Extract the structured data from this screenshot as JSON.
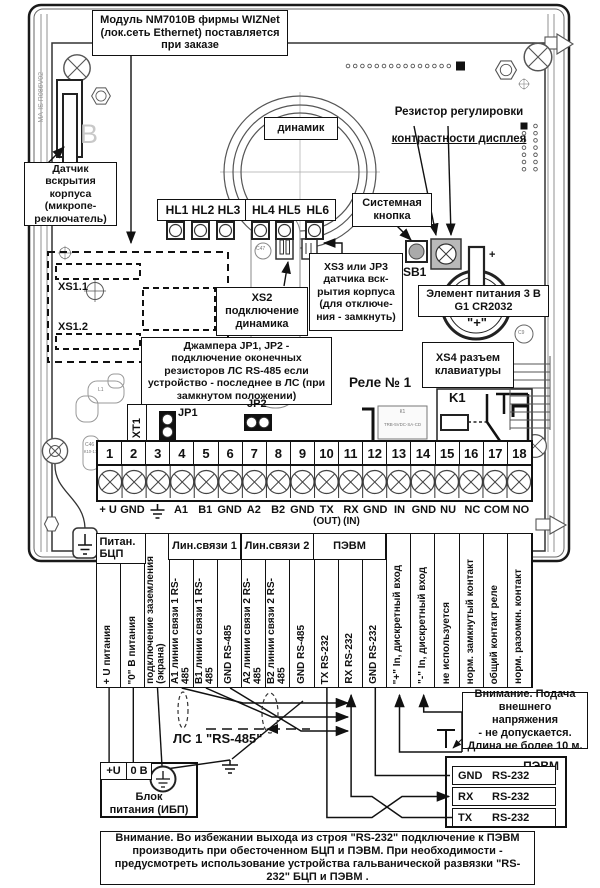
{
  "board": {
    "module_note": "Модуль NM7010В фирмы WIZNet\n(лок.сеть Ethernet) поставляется\nпри заказе",
    "tamper_note": "Датчик вскрытия\nкорпуса (микропе-\nреключатель)",
    "speaker_label": "динамик",
    "contrast_note_line1": "Резистор регулировки",
    "contrast_note_line2": "контрастности дисплея",
    "system_button_note": "Системная\nкнопка",
    "sb1_label": "SB1",
    "battery_note": "Элемент питания 3 В\nG1 CR2032",
    "battery_plus": "\"+\"",
    "battery_clip_plus": "+",
    "xs2_note": "XS2\nподключение\nдинамика",
    "xs3_note": "XS3 или JP3\nдатчика вск-\nрытия корпуса\n(для отключе-\nния - замкнуть)",
    "xs4_note": "XS4 разъем\nклавиатуры",
    "jumper_note": "Джампера JP1, JP2 -\nподключение оконечных\nрезисторов ЛС RS-485 если\nустройство - последнее в ЛС (при\nзамкнутом положении)",
    "xs11_label": "XS1.1",
    "xs12_label": "XS1.2",
    "jp1_label": "JP1",
    "jp2_label": "JP2",
    "xt1_label": "XT1",
    "relay_title": "Реле № 1",
    "k1_label": "K1",
    "relay_ref": "К1",
    "relay_part": "TRB-5VDC-SA-CD",
    "hl123_label": "HL1 HL2 HL3",
    "hl45_label": "HL4 HL5",
    "hl6_label": "HL6",
    "board_code": "MA-IS  R086V02",
    "letter_b": "B",
    "c47_ref": "C47",
    "c46_ref": "C46",
    "c46_type": "К10-17",
    "c9_ref": "C9",
    "l1_ref": "L1"
  },
  "terminals": {
    "numbers": [
      "1",
      "2",
      "3",
      "4",
      "5",
      "6",
      "7",
      "8",
      "9",
      "10",
      "11",
      "12",
      "13",
      "14",
      "15",
      "16",
      "17",
      "18"
    ],
    "signals": [
      "+ U",
      "GND",
      "⏚",
      "A1",
      "B1",
      "GND",
      "A2",
      "B2",
      "GND",
      "TX",
      "RX",
      "GND",
      "IN",
      "GND",
      "NU",
      "NC",
      "COM",
      "NO"
    ],
    "tx_dir": "(OUT)",
    "rx_dir": "(IN)"
  },
  "table": {
    "header_power": "Питан.\nБЦП",
    "header_line1": "Лин.связи 1",
    "header_line2": "Лин.связи 2",
    "header_pc": "ПЭВМ",
    "columns": [
      "+ U питания",
      "\"0\" В питания",
      "подключение заземления\n(экрана)",
      "А1 линии связи 1 RS-\n485",
      "В1 линии связи 1 RS-\n485",
      "GND RS-485",
      "А2 линии связи 2 RS-\n485",
      "В2 линии связи 2 RS-\n485",
      "GND RS-485",
      "TX RS-232",
      "RX RS-232",
      "GND RS-232",
      "\"+\" In, дискретный вход",
      "\"-\" In, дискретный вход",
      "не используется",
      "норм. замкнутый контакт",
      "общий контакт реле",
      "норм. разомкн. контакт"
    ]
  },
  "wiring": {
    "ls1_label": "ЛС 1 \"RS-485\"",
    "psu": {
      "plus": "+U",
      "zero": "0 В",
      "label": "Блок\nпитания (ИБП)"
    },
    "pc": {
      "title": "ПЭВМ",
      "rows": [
        {
          "sig": "GND",
          "bus": "RS-232"
        },
        {
          "sig": "RX",
          "bus": "RS-232"
        },
        {
          "sig": "TX",
          "bus": "RS-232"
        }
      ]
    },
    "voltage_note": "Внимание. Подача\nвнешнего напряжения\n- не допускается.\nДлина не более 10 м.",
    "rs232_note": "Внимание. Во избежании выхода из строя \"RS-232\" подключение к ПЭВМ производить при обесточенном БЦП и ПЭВМ. При необходимости - предусмотреть использование устройства гальванической развязки \"RS-232\" БЦП и ПЭВМ ."
  }
}
